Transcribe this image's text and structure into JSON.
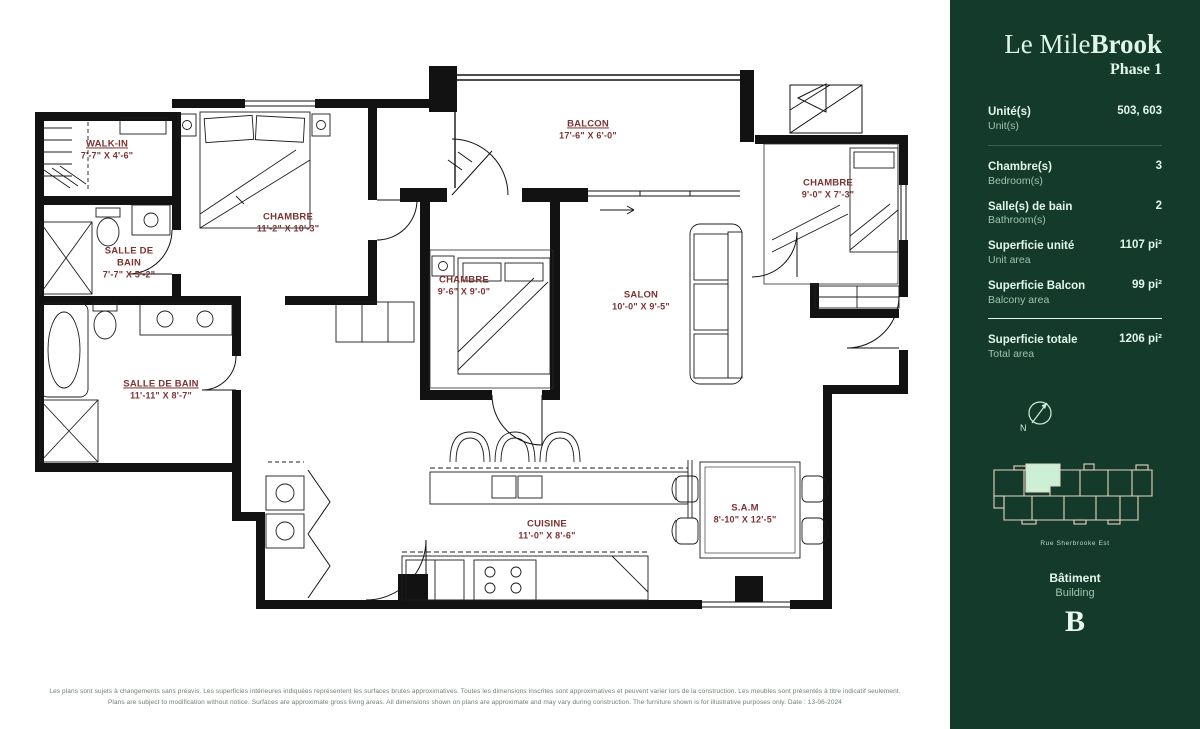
{
  "sidebar": {
    "title_regular": "Le Mile",
    "title_bold": "Brook",
    "phase": "Phase 1",
    "stats": [
      {
        "label": "Unité(s)",
        "sublabel": "Unit(s)",
        "value": "503, 603"
      },
      {
        "label": "Chambre(s)",
        "sublabel": "Bedroom(s)",
        "value": "3"
      },
      {
        "label": "Salle(s) de bain",
        "sublabel": "Bathroom(s)",
        "value": "2"
      },
      {
        "label": "Superficie unité",
        "sublabel": "Unit area",
        "value": "1107 pi²"
      },
      {
        "label": "Superficie Balcon",
        "sublabel": "Balcony area",
        "value": "99 pi²"
      },
      {
        "label": "Superficie totale",
        "sublabel": "Total area",
        "value": "1206 pi²"
      }
    ],
    "compass_letter": "N",
    "street_caption": "Rue Sherbrooke Est",
    "building_label": "Bâtiment",
    "building_sublabel": "Building",
    "building_letter": "B"
  },
  "floorplan": {
    "rooms": [
      {
        "name": "WALK-IN",
        "dims": "7'-7\" X 4'-6\""
      },
      {
        "name": "SALLE DE BAIN",
        "dims": "7'-7\" X 5'-2\""
      },
      {
        "name": "CHAMBRE",
        "dims": "11'-2\" X 10'-3\""
      },
      {
        "name": "CHAMBRE",
        "dims": "9'-6\" X 9'-0\""
      },
      {
        "name": "BALCON",
        "dims": "17'-6\" X 6'-0\""
      },
      {
        "name": "SALON",
        "dims": "10'-0\" X 9'-5\""
      },
      {
        "name": "CHAMBRE",
        "dims": "9'-0\" X 7'-3\""
      },
      {
        "name": "SALLE DE BAIN",
        "dims": "11'-11\" X 8'-7\""
      },
      {
        "name": "CUISINE",
        "dims": "11'-0\" X 8'-6\""
      },
      {
        "name": "S.A.M",
        "dims": "8'-10\" X 12'-5\""
      }
    ]
  },
  "footer": {
    "line1": "Les plans sont sujets à changements sans préavis. Les superficies intérieures indiquées représentent les surfaces brutes approximatives. Toutes les dimensions inscrites sont approximatives et peuvent varier lors de la construction. Les meubles sont présentés à titre indicatif seulement.",
    "line2": "Plans are subject to modification without notice. Surfaces are approximate gross living areas. All dimensions shown on plans are approximate and may vary during construction. The furniture shown is for illustrative purposes only. Date : 13-06-2024"
  },
  "colors": {
    "sidebar_green": "#143a2b",
    "mint_text": "#dff5e7",
    "label_red": "#7d3232",
    "map_outline": "#e9d3c0",
    "unit_highlight": "#ccf0d6"
  }
}
